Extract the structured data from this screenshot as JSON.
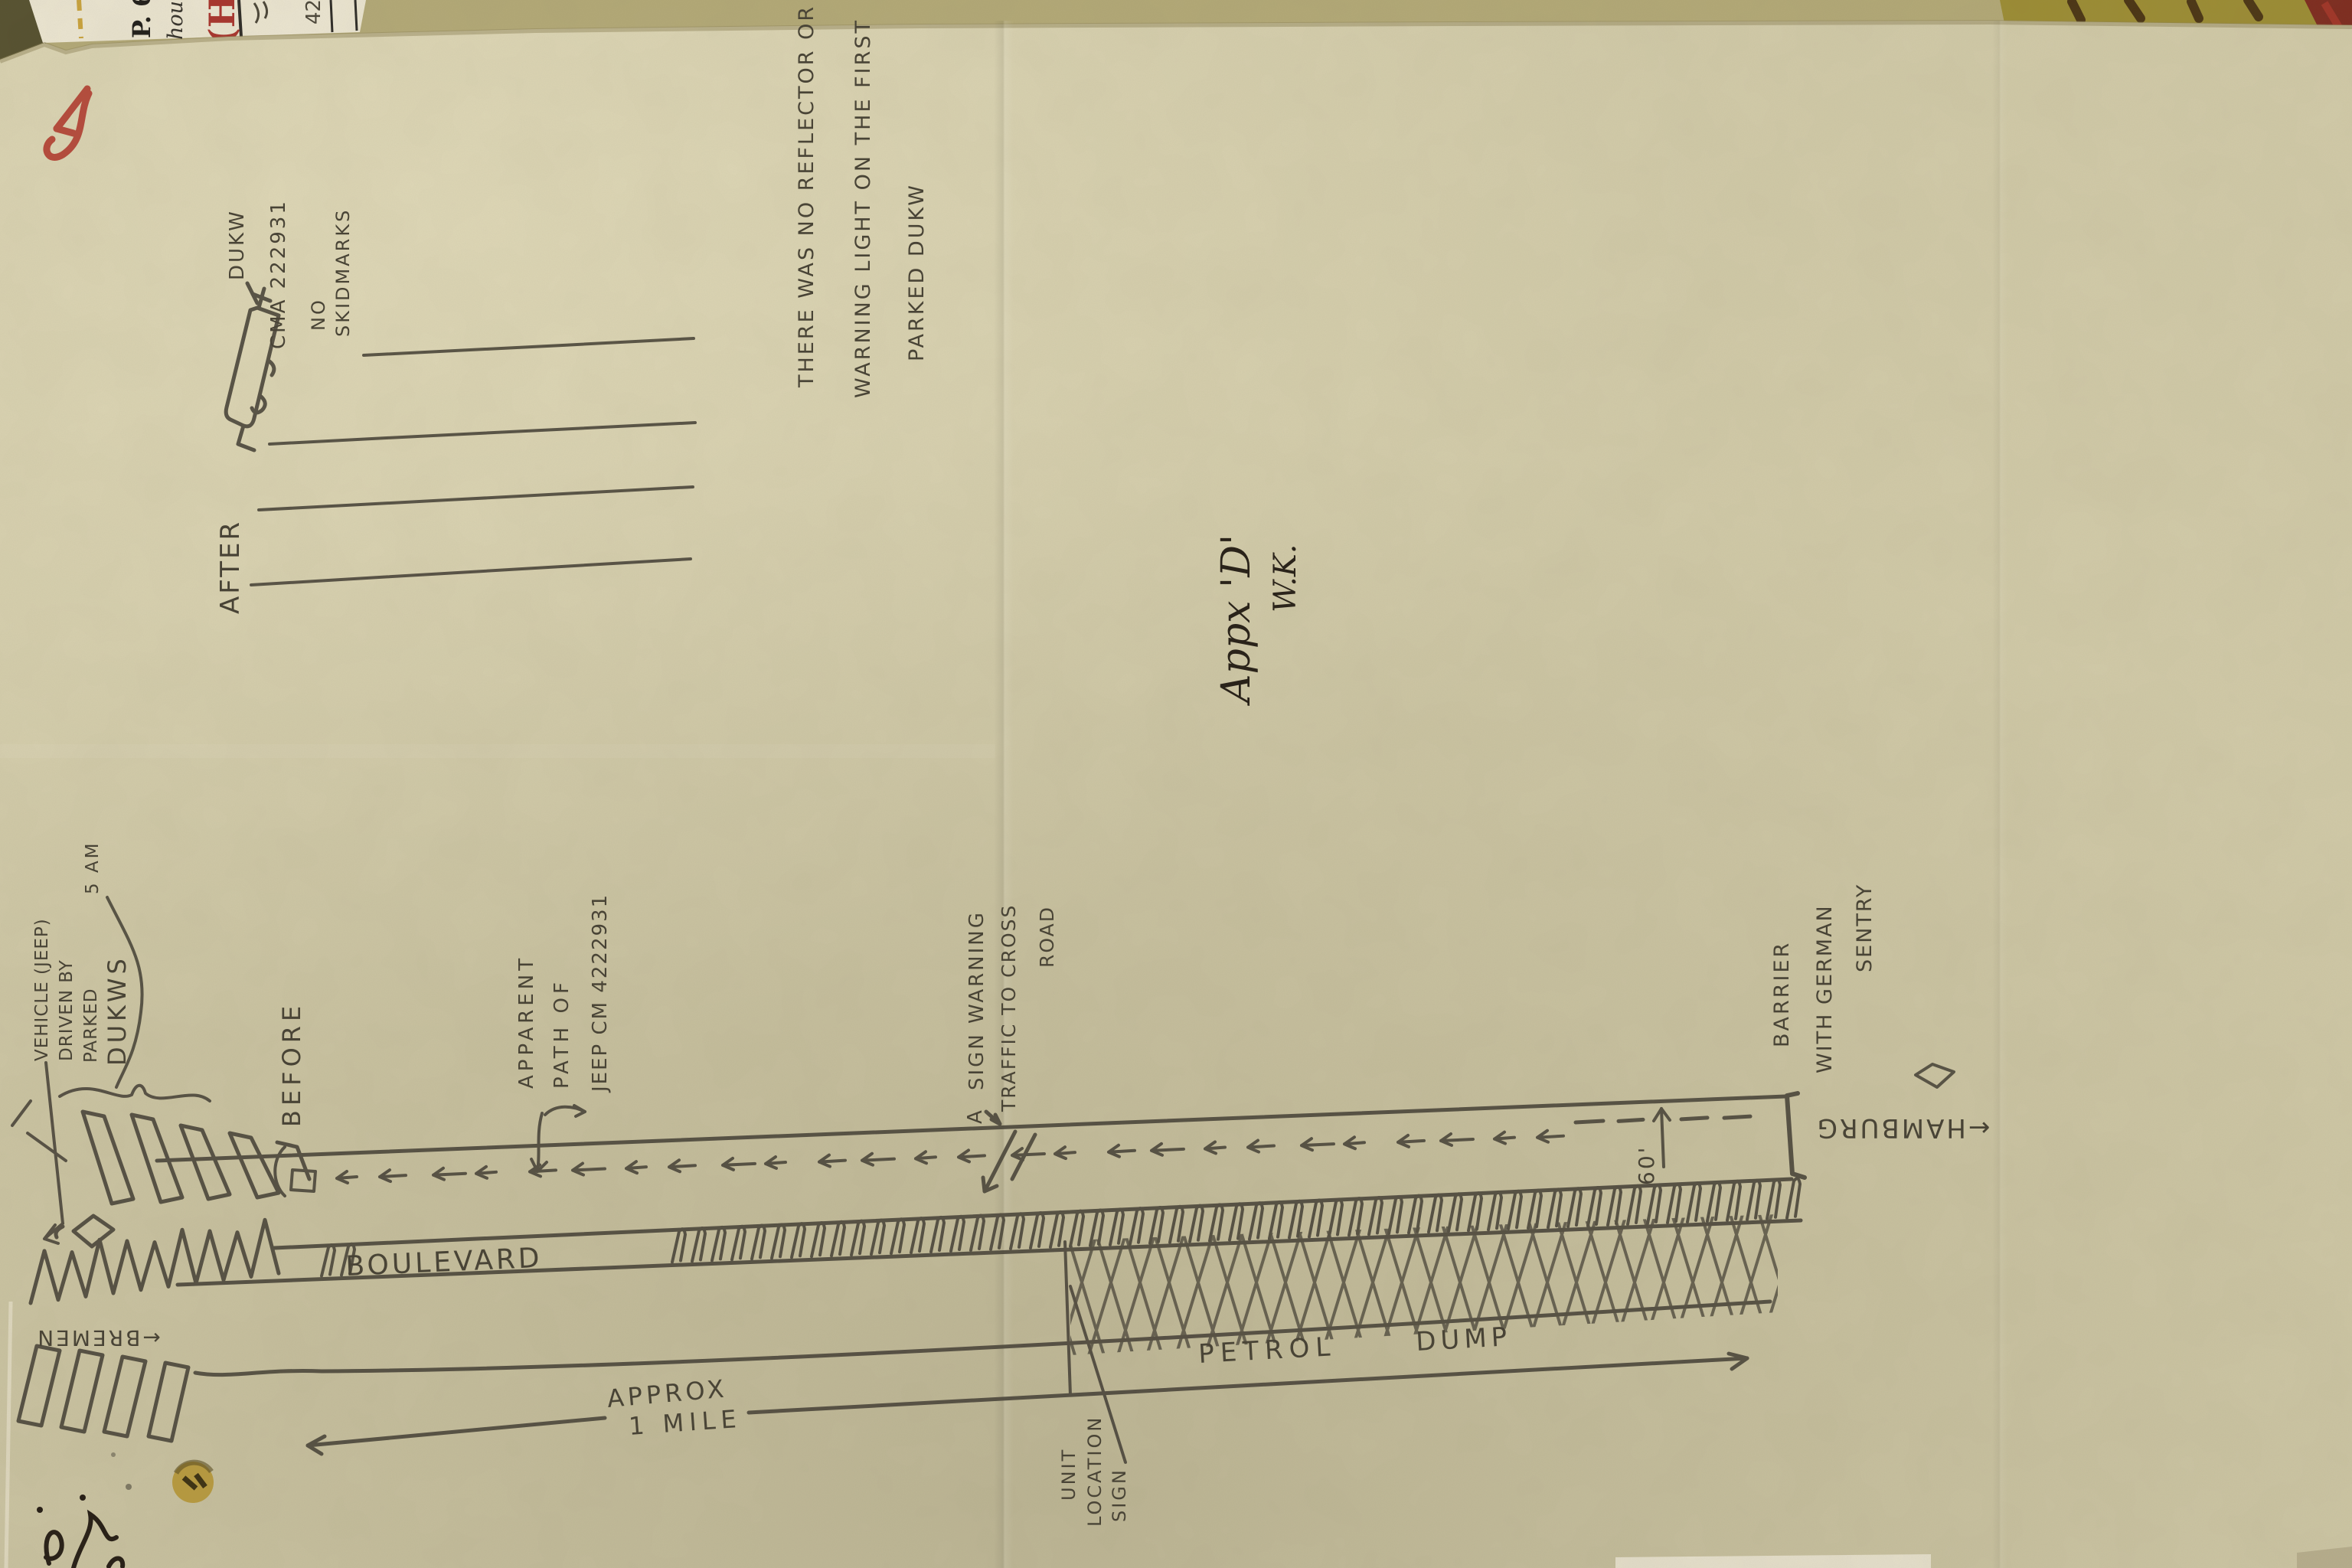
{
  "page_marker": {
    "number": "5",
    "color": "#b23a2e"
  },
  "top_documents": {
    "typed_fragment": "P. 6",
    "handwritten_fragment": "houl",
    "red_stamp_fragment": "(H)",
    "pencil_fragment": "42"
  },
  "after_view": {
    "title": "AFTER",
    "vehicle_label": "DUKW",
    "vehicle_number": "CMA 222931",
    "note_line1": "NO",
    "note_line2": "SKIDMARKS"
  },
  "reflector_note": {
    "line1": "THERE WAS NO REFLECTOR OR",
    "line2": "WARNING LIGHT ON THE FIRST",
    "line3": "PARKED DUKW"
  },
  "signature": {
    "appendix": "Appx 'D'",
    "initials": "W.K."
  },
  "before_view": {
    "title": "BEFORE",
    "vehicle_callout": {
      "line1": "VEHICLE (JEEP)",
      "line2": "DRIVEN BY",
      "line3": "PARKED",
      "time": "5 AM",
      "line4": "DUKWS"
    },
    "path_callout": {
      "line1": "APPARENT",
      "line2": "PATH OF",
      "line3": "JEEP CM 4222931"
    },
    "sign_callout": {
      "prefix": "A",
      "line1": "SIGN WARNING",
      "line2": "TRAFFIC TO CROSS",
      "line3": "ROAD"
    },
    "barrier_callout": {
      "line1": "BARRIER",
      "line2": "WITH GERMAN",
      "line3": "SENTRY"
    },
    "distance_to_barrier": "60'",
    "direction_right": "←HAMBURG",
    "direction_left": "←BREMEN",
    "road_name": "BOULEVARD",
    "petrol_word1": "PETROL",
    "petrol_word2": "DUMP",
    "scale_line1": "APPROX",
    "scale_line2": "1 MILE",
    "unit_sign": {
      "line1": "UNIT",
      "line2": "LOCATION",
      "line3": "SIGN"
    }
  },
  "colors": {
    "paper": "#d2cba9",
    "pencil": "#4b463b",
    "red_marker": "#b23a2e",
    "ink": "#241d15",
    "under_paper_olive": "#9c8c33",
    "typed_paper": "#ece6d2"
  }
}
